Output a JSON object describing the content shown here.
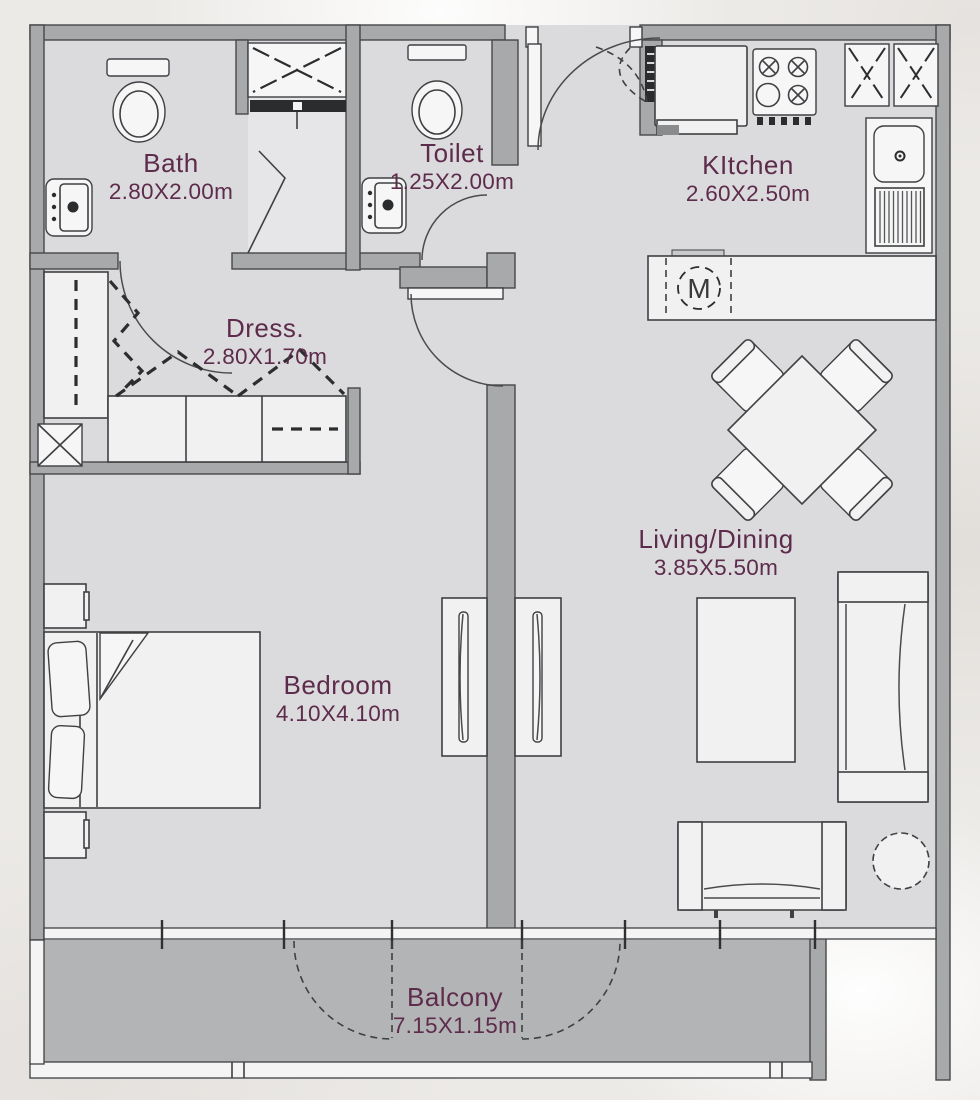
{
  "plan": {
    "type": "apartment-floor-plan"
  },
  "rooms": [
    {
      "id": "bath",
      "label": "Bath",
      "dimensions": "2.80X2.00m"
    },
    {
      "id": "toilet",
      "label": "Toilet",
      "dimensions": "1.25X2.00m"
    },
    {
      "id": "kitchen",
      "label": "KItchen",
      "dimensions": "2.60X2.50m"
    },
    {
      "id": "dress",
      "label": "Dress.",
      "dimensions": "2.80X1.70m"
    },
    {
      "id": "living_dining",
      "label": "Living/Dining",
      "dimensions": "3.85X5.50m"
    },
    {
      "id": "bedroom",
      "label": "Bedroom",
      "dimensions": "4.10X4.10m"
    },
    {
      "id": "balcony",
      "label": "Balcony",
      "dimensions": "7.15X1.15m"
    }
  ],
  "appliances": {
    "washing_machine_label": "M"
  },
  "fixtures": [
    "toilet",
    "washbasin",
    "shower",
    "duct-shaft",
    "fridge",
    "stove",
    "kitchen-sink",
    "washing-machine",
    "closet",
    "wardrobe",
    "bed",
    "nightstand",
    "dining-table",
    "dining-chair",
    "sofa",
    "coffee-table",
    "round-side-table",
    "entry-door",
    "balcony-door",
    "window-wall",
    "railing"
  ],
  "colors": {
    "wall": "#a7a9ab",
    "floor": "#dbdbdd",
    "balcony_floor": "#b3b4b6",
    "line": "#3f4042",
    "label_text": "#5d2b4b",
    "background": "#edeae8"
  }
}
